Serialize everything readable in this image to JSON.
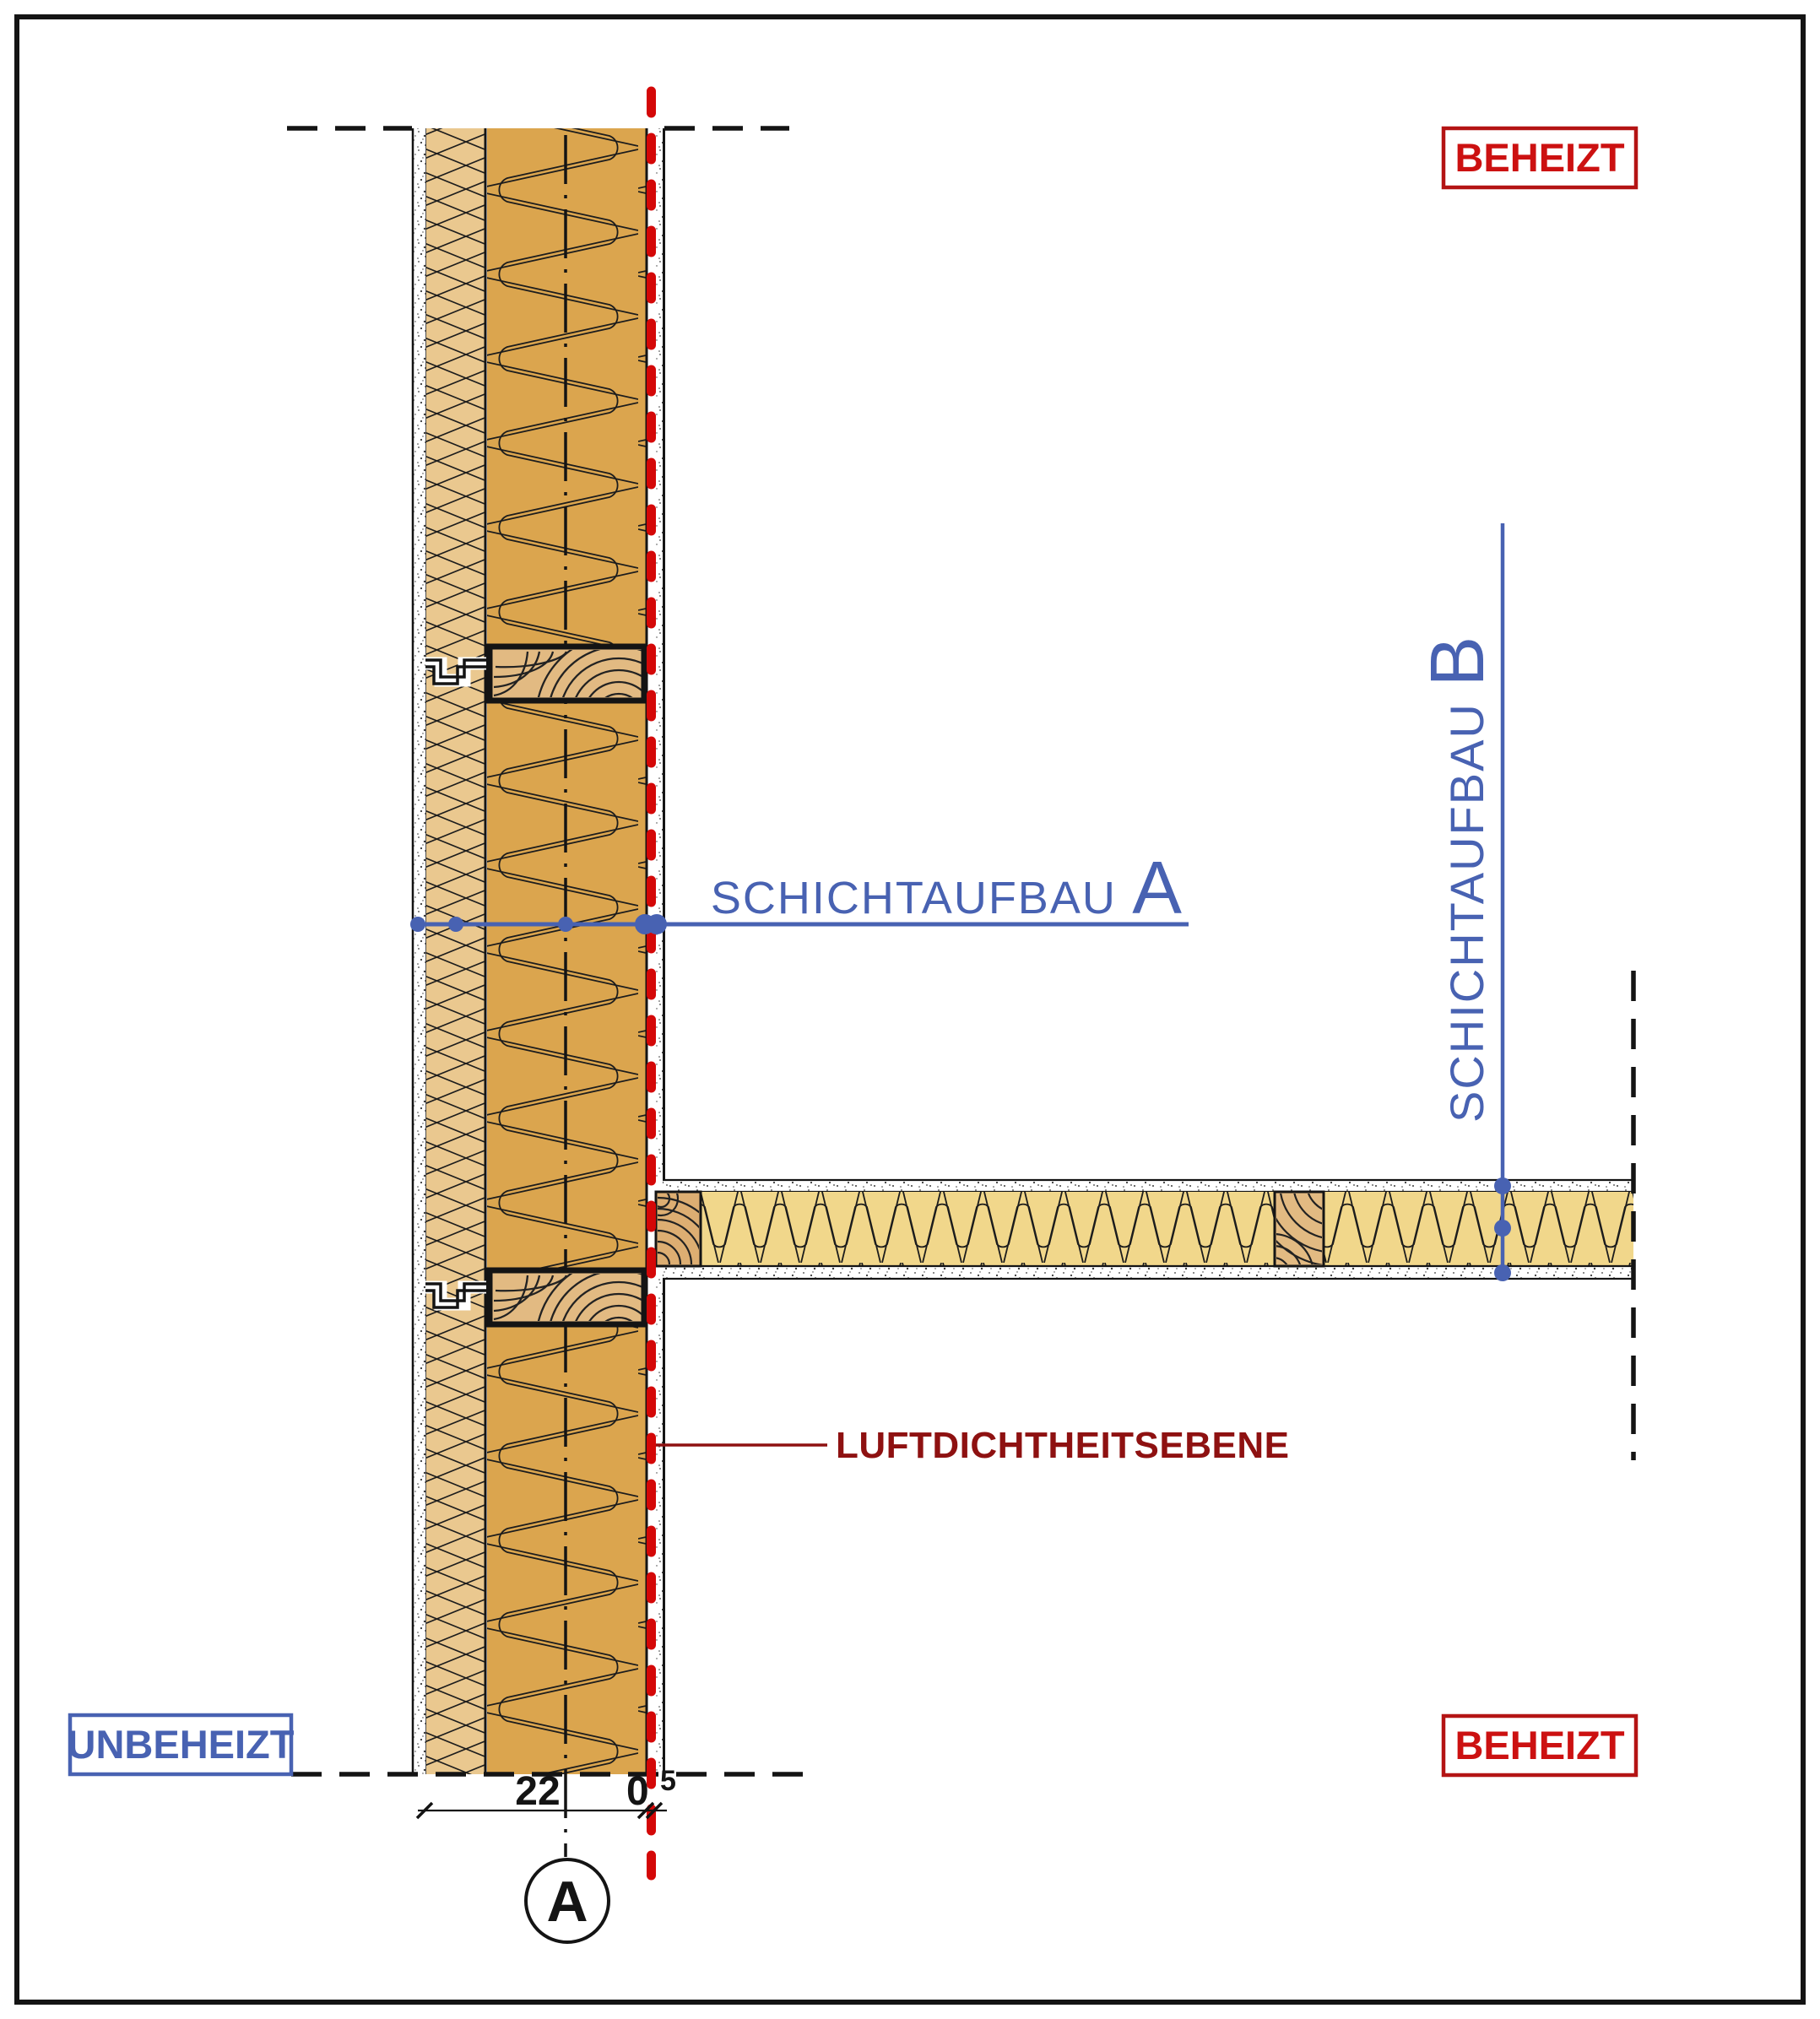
{
  "drawing": {
    "zones": {
      "beheizt_top": "BEHEIZT",
      "beheizt_bottom": "BEHEIZT",
      "unbeheizt": "UNBEHEIZT"
    },
    "annotations": {
      "layer_a_word": "SCHICHTAUFBAU",
      "layer_a_letter": "A",
      "layer_b_word": "SCHICHTAUFBAU",
      "layer_b_letter": "B",
      "airtightness_label": "LUFTDICHTHEITSEBENE",
      "section_marker": "A"
    },
    "dimensions": {
      "insulation_width": "22",
      "board_width_main": "0",
      "board_width_sup": "5"
    },
    "colors": {
      "annotation-blue": "#4862b2",
      "zone-red": "#cc1111",
      "zone-red-border": "#b41414",
      "airtight-red": "#8e1111",
      "airtight-dash-red": "#d40808",
      "wall-insulation": "#dba54e",
      "fiber-insulation": "#eac88f",
      "floor-insulation": "#f1d78b",
      "wood": "#e2ba82",
      "wood-dark": "#ddae72",
      "line-black": "#141414"
    }
  }
}
